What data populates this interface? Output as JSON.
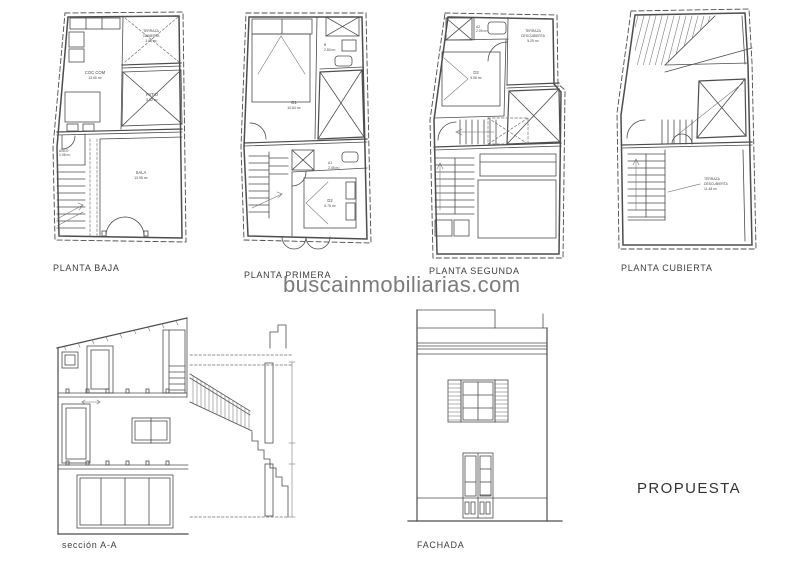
{
  "watermark": "buscainmobiliarias.com",
  "proposal": "PROPUESTA",
  "section": {
    "label": "sección A-A"
  },
  "facade": {
    "label": "FACHADA"
  },
  "colors": {
    "line": "#4d4d4d",
    "text": "#3e3e3e",
    "watermark": "#7b7b7b",
    "background": "#ffffff"
  },
  "plans": {
    "baja": {
      "label": "PLANTA BAJA",
      "rooms": {
        "terraza": {
          "l1": "TERRAZA",
          "l2": "CUBIERTA",
          "area": "3.06 m²"
        },
        "coccom": {
          "l1": "COC COM",
          "area": "13.65 m²"
        },
        "patio": {
          "l1": "PATIO",
          "area": "5.02 m²"
        },
        "aseo": {
          "l1": "ASEO",
          "area": "1.08 m²"
        },
        "sala": {
          "l1": "SALA",
          "area": "13.95 m²"
        }
      }
    },
    "primera": {
      "label": "PLANTA PRIMERA",
      "rooms": {
        "d1": {
          "l1": "D1",
          "area": "10.84 m²"
        },
        "b": {
          "l1": "B",
          "area": "2.80 m²"
        },
        "a1": {
          "l1": "A1",
          "area": "2.05 m²"
        },
        "d2": {
          "l1": "D2",
          "area": "6.75 m²"
        }
      }
    },
    "segunda": {
      "label": "PLANTA SEGUNDA",
      "rooms": {
        "a2": {
          "l1": "A2",
          "area": "2.05 m²"
        },
        "d3": {
          "l1": "D3",
          "area": "9.08 m²"
        },
        "terraza": {
          "l1": "TERRAZA",
          "l2": "DESCUBIERTA",
          "area": "5.25 m²"
        }
      }
    },
    "cubierta": {
      "label": "PLANTA CUBIERTA",
      "rooms": {
        "terraza": {
          "l1": "TERRAZA",
          "l2": "DESCUBIERTA",
          "area": "11.48 m²"
        }
      }
    }
  }
}
